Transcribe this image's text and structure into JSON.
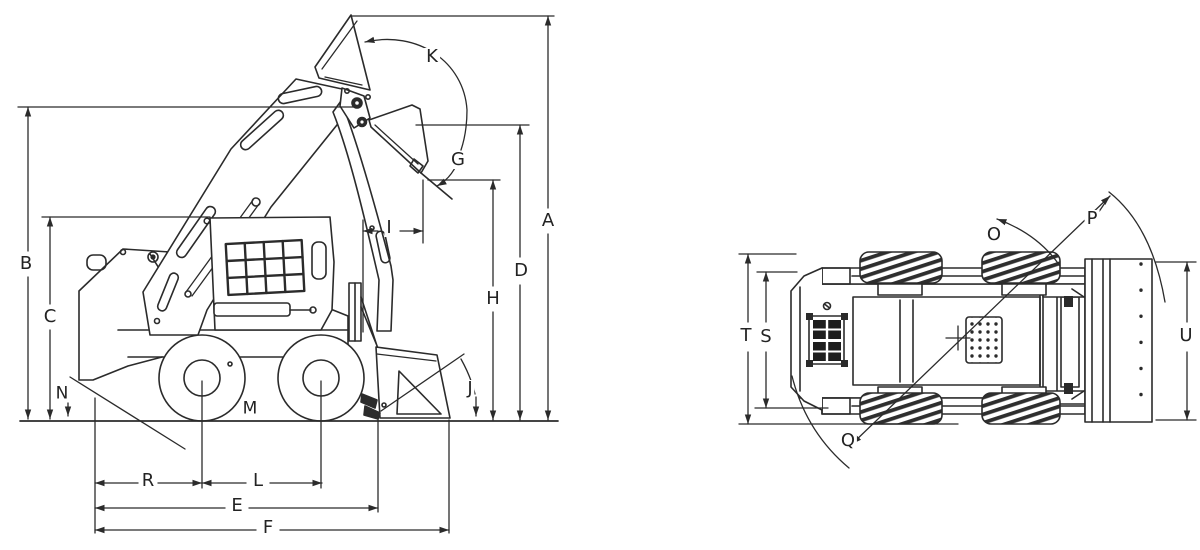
{
  "side_view": {
    "dimension_labels": {
      "A": "A",
      "B": "B",
      "C": "C",
      "D": "D",
      "E": "E",
      "F": "F",
      "G": "G",
      "H": "H",
      "I": "I",
      "J": "J",
      "K": "K",
      "L": "L",
      "M": "M",
      "N": "N",
      "R": "R"
    }
  },
  "top_view": {
    "dimension_labels": {
      "O": "O",
      "P": "P",
      "Q": "Q",
      "S": "S",
      "T": "T",
      "U": "U"
    }
  },
  "colors": {
    "line_color": "#2b2b2b",
    "background": "#ffffff"
  }
}
